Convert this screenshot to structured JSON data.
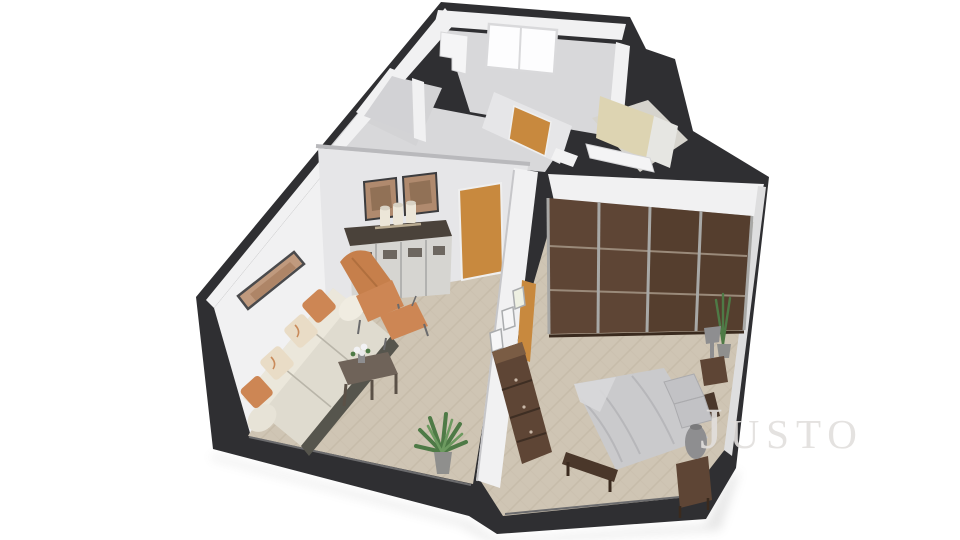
{
  "watermark": {
    "text": "Justo"
  },
  "colors": {
    "background": "#ffffff",
    "wall_cut_dark": "#2f2f32",
    "wall_face_white": "#f1f1f2",
    "wall_face_shaded": "#e6e6e8",
    "interior_gray": "#d2d2d5",
    "floor_wood": "#cfc5b4",
    "floor_wood_lines": "#bdb19d",
    "floor_gray": "#d8d8da",
    "door_orange": "#c8893e",
    "window_white": "#fdfdfe",
    "bathroom_beige": "#ddd4b2",
    "sofa_cream": "#dfdbcf",
    "sofa_back_cream": "#ebe7db",
    "sofa_base_dark": "#56554d",
    "accent_orange": "#cd8654",
    "armchair_orange": "#c67f4b",
    "pillow_cream": "#e9dcc6",
    "wood_dark": "#5e4535",
    "wood_medium": "#6f6359",
    "sideboard_body": "#d6d5d1",
    "sideboard_top": "#4a423a",
    "bed_gray": "#cacacc",
    "pillow_gray": "#c2c2c5",
    "lamp_gray": "#8e8e90",
    "plant_green": "#4e7a46",
    "metal_silver": "#a8a8a6",
    "art_landscape": "#c09a7e",
    "art_rust": "#b08a6e",
    "watermark_gray": "#e2dfdd"
  },
  "scene": {
    "type": "3d-floor-plan-render",
    "view": "isometric cutaway, white background",
    "rooms": [
      {
        "name": "living-room",
        "furniture": [
          "three-seat-sofa",
          "accent-pillows",
          "orange-armchair",
          "orange-ottoman",
          "coffee-table-with-flowers",
          "sideboard-with-canisters",
          "wall-art-landscape",
          "wall-art-pair",
          "potted-plant",
          "orange-interior-door"
        ]
      },
      {
        "name": "bedroom",
        "furniture": [
          "sliding-door-wardrobe",
          "double-bed",
          "dresser",
          "nightstand",
          "nightstand-lamp",
          "floor-vase",
          "corner-plant",
          "gallery-frames",
          "orange-interior-door"
        ]
      },
      {
        "name": "hallway",
        "furniture": [
          "orange-interior-door"
        ]
      },
      {
        "name": "back-room",
        "furniture": [
          "window",
          "white-cabinet"
        ]
      },
      {
        "name": "bathroom",
        "furniture": [
          "beige-shower-wall",
          "white-ledge"
        ]
      },
      {
        "name": "closet-room",
        "furniture": []
      }
    ]
  }
}
